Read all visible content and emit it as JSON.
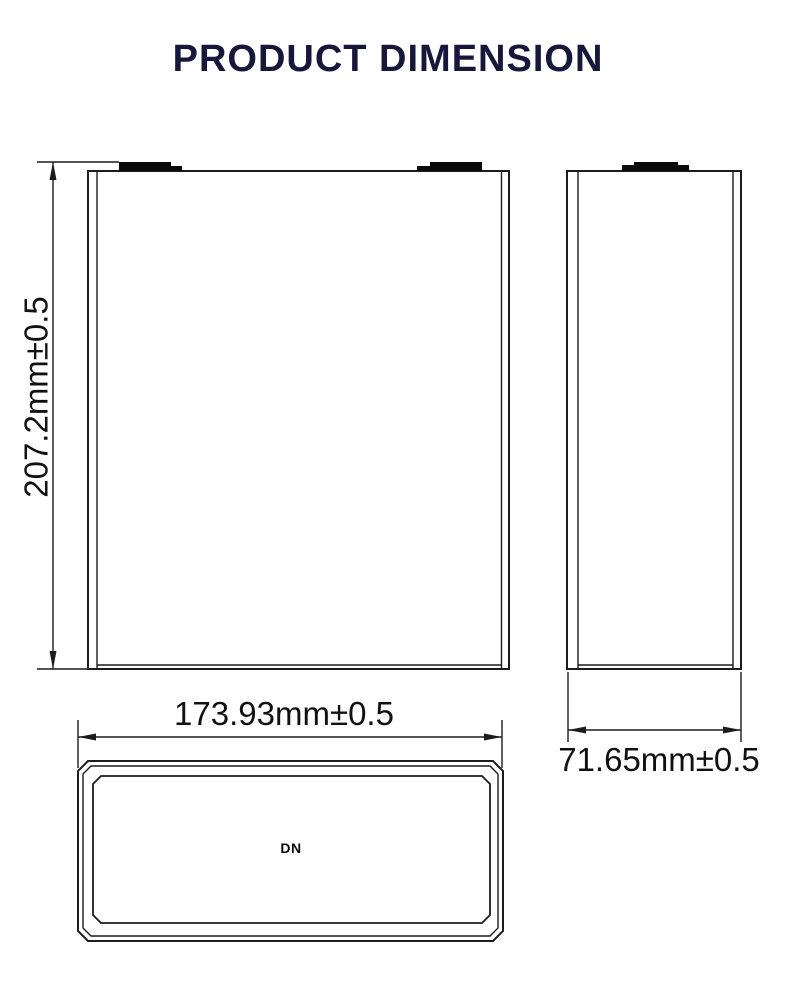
{
  "title": {
    "text": "PRODUCT DIMENSION",
    "color": "#17173b"
  },
  "drawing": {
    "front_view": {
      "height_dimension": "207.2mm±0.5",
      "width_dimension": "173.93mm±0.5"
    },
    "side_view": {
      "width_dimension": "71.65mm±0.5"
    },
    "top_view": {
      "marking": "DN"
    }
  },
  "colors": {
    "background": "#ffffff",
    "line": "#1c1c1c",
    "terminal_fill": "#0a0a0a",
    "title": "#17173b"
  }
}
